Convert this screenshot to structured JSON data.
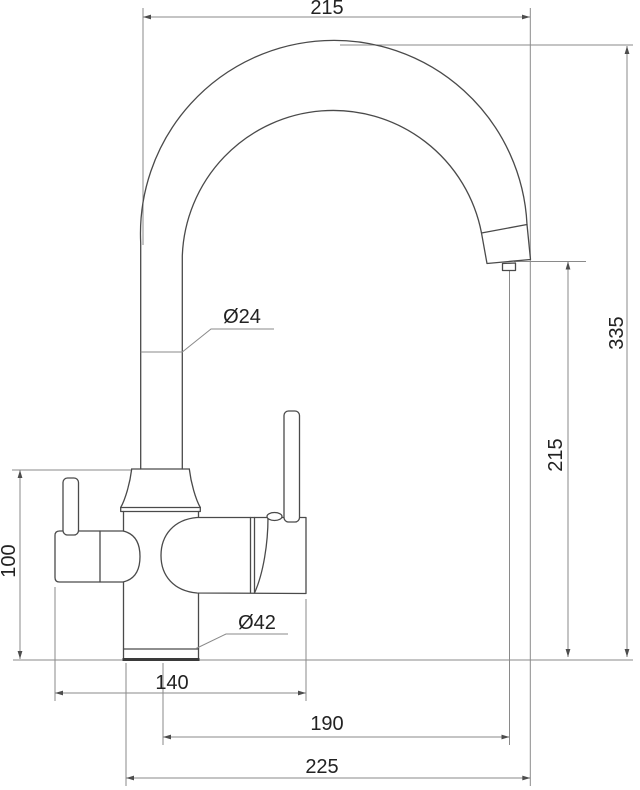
{
  "drawing": {
    "object": "kitchen-faucet-two-handle-side-view",
    "colors": {
      "background": "#ffffff",
      "outline": "#4a4a4a",
      "dimension_lines": "#8a8a8a",
      "text": "#222222"
    },
    "dimensions": {
      "top_width": "215",
      "spout_tube_diameter": "Ø24",
      "overall_height": "335",
      "outlet_height": "215",
      "left_body_height": "100",
      "body_diameter": "Ø42",
      "width_body_span": "140",
      "width_spout_reach": "190",
      "width_overall": "225"
    }
  }
}
